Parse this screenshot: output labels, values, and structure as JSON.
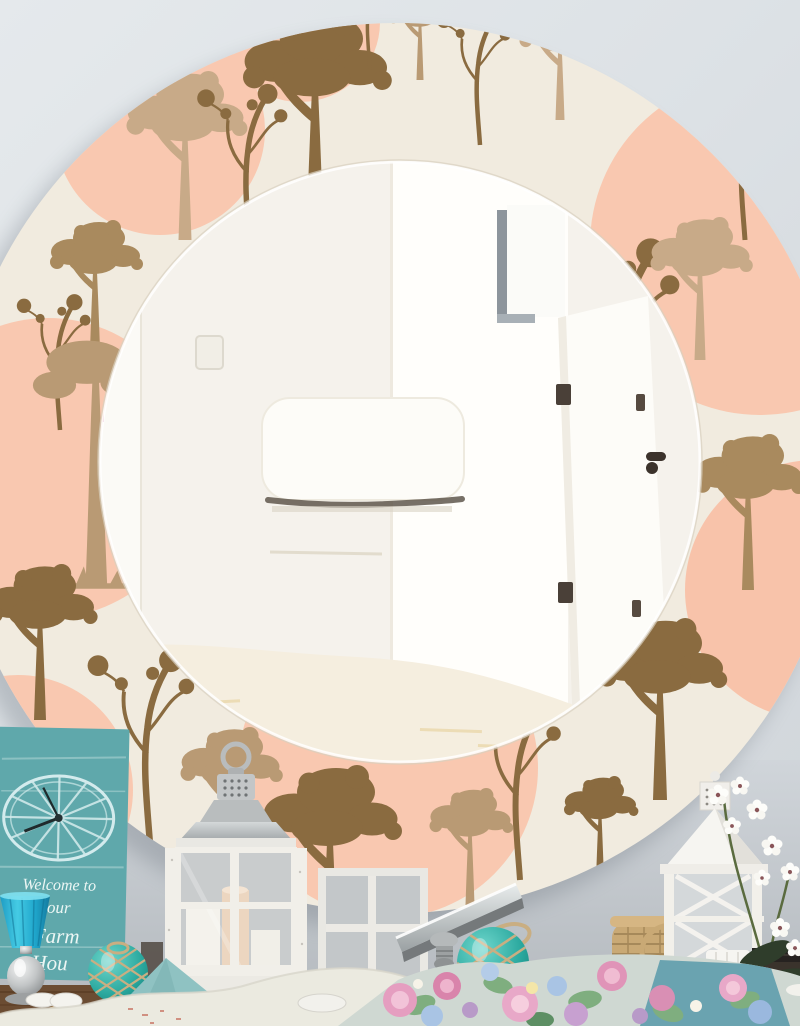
{
  "scene": {
    "description": "Round wall mirror with woodland tree pattern frame reflecting a bright white hallway, styled above a farmhouse decor table",
    "wall_color": "#dde2e6"
  },
  "mirror": {
    "frame": {
      "background": "#f1ebdf",
      "circle_accent": "#f9c8b0",
      "tree_dark": "#8a6b40",
      "tree_mid": "#a98a5e",
      "tree_light": "#c8aa88"
    },
    "reflection": {
      "wall": "#f5f2ec",
      "doorway": "#fffefb",
      "floor": "#f6efe0",
      "hinge_color": "#4a4038"
    }
  },
  "sign": {
    "line1": "Welcome to",
    "line2": "our",
    "line3": "Farm",
    "line4": "Hou",
    "board_color": "#5fa8ab",
    "text_color": "#ecf6f4"
  },
  "props": {
    "left": [
      "wagon-wheel clock sign",
      "blue glass goblet",
      "white pebbles",
      "teal glass float with rope net",
      "jute mat"
    ],
    "center": [
      "white candle lantern with pillar candles",
      "mirrored display box",
      "teal glass float with rope net"
    ],
    "right": [
      "wicker basket",
      "white lantern with cross panes",
      "white orchid",
      "stacked dark books",
      "floral pillow"
    ]
  },
  "palette": {
    "teal_glass": "#2aa89e",
    "rope": "#c9ae82",
    "lantern_white": "#f1efe9",
    "pillow_teal": "#8fc2c2",
    "pillow_cream": "#ecebe1",
    "wood_table": "#6b4c32"
  }
}
